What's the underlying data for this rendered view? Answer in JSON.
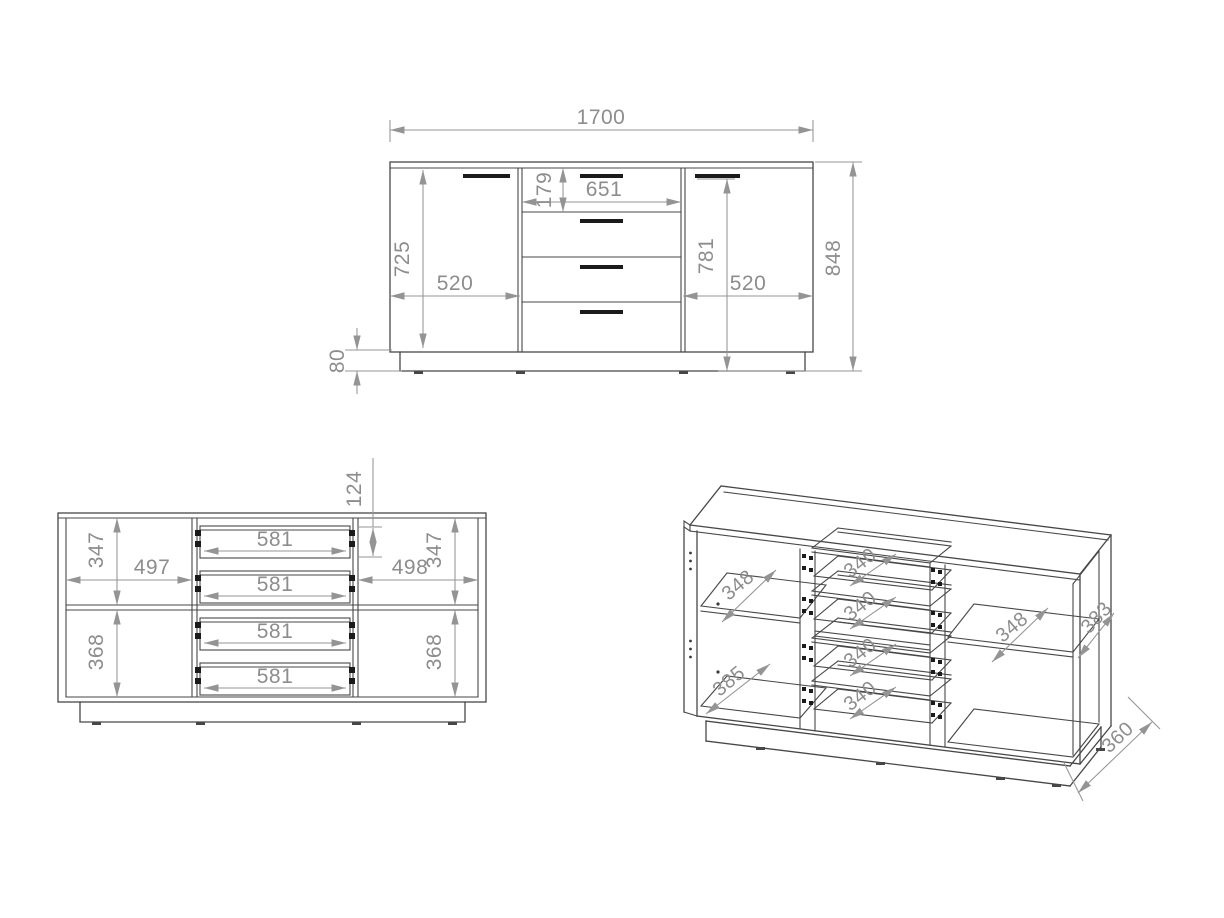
{
  "drawing": {
    "front_elevation": {
      "overall_width": "1700",
      "overall_height": "848",
      "left_door_height": "725",
      "left_door_width": "520",
      "top_drawer_height": "179",
      "drawer_opening_width": "651",
      "right_section_height": "781",
      "right_door_width": "520",
      "plinth_height": "80"
    },
    "front_internal": {
      "left_top_compartment_height": "347",
      "left_compartment_width": "497",
      "left_bottom_compartment_height": "368",
      "drawer_box_height": "124",
      "right_compartment_width": "498",
      "right_top_compartment_height": "347",
      "right_bottom_compartment_height": "368",
      "drawer_widths": [
        "581",
        "581",
        "581",
        "581"
      ]
    },
    "isometric": {
      "left_shelf_depth": "348",
      "left_bottom_depth": "385",
      "drawer_depths": [
        "340",
        "340",
        "340",
        "340"
      ],
      "right_shelf_depth": "348",
      "side_panel_depth": "383",
      "plinth_depth": "360"
    }
  }
}
